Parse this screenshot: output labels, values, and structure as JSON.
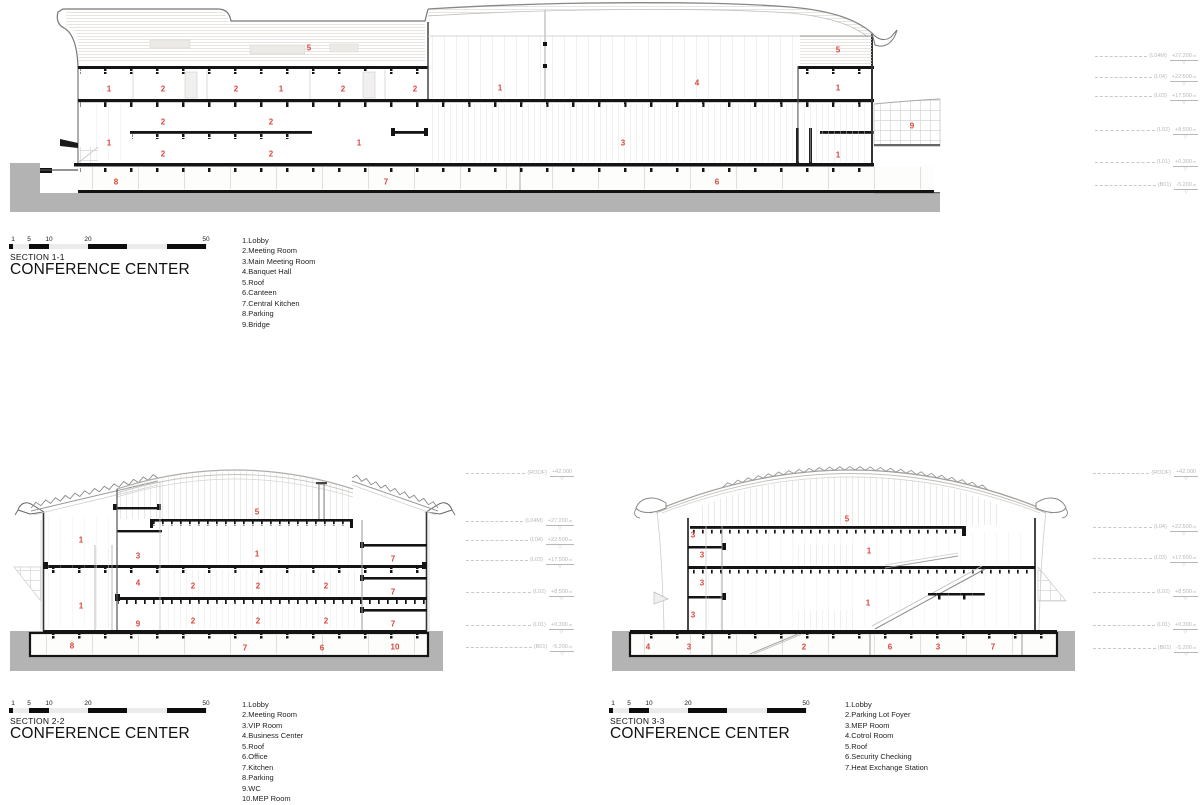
{
  "sheet": {
    "background": "#ffffff"
  },
  "colors": {
    "label_red": "#d8473c",
    "ground_gray": "#b3b3b3",
    "cut_black": "#141414",
    "marker_gray": "#b8b8b8"
  },
  "sections": [
    {
      "id": "section-1-1",
      "section_label": "SECTION 1-1",
      "title": "CONFERENCE CENTER",
      "scale_ticks": [
        "1",
        "5",
        "10",
        "20",
        "50"
      ],
      "legend_items": [
        "1.Lobby",
        "2.Meeting Room",
        "3.Main Meeting Room",
        "4.Banquet Hall",
        "5.Roof",
        "6.Canteen",
        "7.Central Kitchen",
        "8.Parking",
        "9.Bridge"
      ],
      "layout": {
        "scale_x": 9,
        "scale_y": 236,
        "label_x": 10,
        "label_y": 252,
        "title_x": 10,
        "title_y": 261,
        "legend_x": 242,
        "legend_y": 236
      },
      "labels": [
        {
          "t": "5",
          "x": 309,
          "y": 48
        },
        {
          "t": "1",
          "x": 109,
          "y": 89
        },
        {
          "t": "2",
          "x": 163,
          "y": 89
        },
        {
          "t": "2",
          "x": 236,
          "y": 89
        },
        {
          "t": "1",
          "x": 281,
          "y": 89
        },
        {
          "t": "2",
          "x": 343,
          "y": 89
        },
        {
          "t": "2",
          "x": 415,
          "y": 89
        },
        {
          "t": "1",
          "x": 500,
          "y": 88
        },
        {
          "t": "4",
          "x": 697,
          "y": 83
        },
        {
          "t": "5",
          "x": 838,
          "y": 50
        },
        {
          "t": "1",
          "x": 838,
          "y": 88
        },
        {
          "t": "2",
          "x": 163,
          "y": 122
        },
        {
          "t": "2",
          "x": 271,
          "y": 122
        },
        {
          "t": "9",
          "x": 912,
          "y": 126
        },
        {
          "t": "1",
          "x": 109,
          "y": 143
        },
        {
          "t": "1",
          "x": 359,
          "y": 143
        },
        {
          "t": "3",
          "x": 623,
          "y": 143
        },
        {
          "t": "2",
          "x": 163,
          "y": 154
        },
        {
          "t": "2",
          "x": 271,
          "y": 154
        },
        {
          "t": "1",
          "x": 838,
          "y": 155
        },
        {
          "t": "8",
          "x": 116,
          "y": 182
        },
        {
          "t": "7",
          "x": 386,
          "y": 182
        },
        {
          "t": "6",
          "x": 717,
          "y": 182
        }
      ],
      "levels": {
        "x": 1095,
        "w": 103,
        "rows": [
          {
            "n": "(L04M)",
            "v": "+27.200",
            "u": "m",
            "y": 56
          },
          {
            "n": "(L04)",
            "v": "+22.500",
            "u": "m",
            "y": 77
          },
          {
            "n": "(L03)",
            "v": "+17.500",
            "u": "m",
            "y": 96
          },
          {
            "n": "(L02)",
            "v": "+8.500",
            "u": "m",
            "y": 130
          },
          {
            "n": "(L01)",
            "v": "+0.300",
            "u": "m",
            "y": 162
          },
          {
            "n": "(B01)",
            "v": "-5.200",
            "u": "m",
            "y": 185
          }
        ]
      }
    },
    {
      "id": "section-2-2",
      "section_label": "SECTION 2-2",
      "title": "CONFERENCE CENTER",
      "scale_ticks": [
        "1",
        "5",
        "10",
        "20",
        "50"
      ],
      "legend_items": [
        "1.Lobby",
        "2.Meeting Room",
        "3.VIP Room",
        "4.Business Center",
        "5.Roof",
        "6.Office",
        "7.Kitchen",
        "8.Parking",
        "9.WC",
        "10.MEP Room"
      ],
      "layout": {
        "scale_x": 9,
        "scale_y": 700,
        "label_x": 10,
        "label_y": 716,
        "title_x": 10,
        "title_y": 725,
        "legend_x": 242,
        "legend_y": 700
      },
      "labels": [
        {
          "t": "5",
          "x": 257,
          "y": 512
        },
        {
          "t": "1",
          "x": 81,
          "y": 540
        },
        {
          "t": "3",
          "x": 138,
          "y": 556
        },
        {
          "t": "1",
          "x": 257,
          "y": 554
        },
        {
          "t": "7",
          "x": 393,
          "y": 559
        },
        {
          "t": "4",
          "x": 138,
          "y": 583
        },
        {
          "t": "2",
          "x": 193,
          "y": 586
        },
        {
          "t": "2",
          "x": 258,
          "y": 586
        },
        {
          "t": "2",
          "x": 326,
          "y": 586
        },
        {
          "t": "7",
          "x": 393,
          "y": 592
        },
        {
          "t": "1",
          "x": 81,
          "y": 606
        },
        {
          "t": "9",
          "x": 138,
          "y": 624
        },
        {
          "t": "2",
          "x": 193,
          "y": 621
        },
        {
          "t": "2",
          "x": 258,
          "y": 621
        },
        {
          "t": "2",
          "x": 326,
          "y": 621
        },
        {
          "t": "7",
          "x": 393,
          "y": 624
        },
        {
          "t": "8",
          "x": 72,
          "y": 646
        },
        {
          "t": "7",
          "x": 245,
          "y": 648
        },
        {
          "t": "6",
          "x": 322,
          "y": 648
        },
        {
          "t": "10",
          "x": 395,
          "y": 647
        }
      ],
      "levels": {
        "x": 466,
        "w": 108,
        "rows": [
          {
            "n": "(ROOF)",
            "v": "+42.000",
            "u": "",
            "y": 473
          },
          {
            "n": "(L04M)",
            "v": "+27.200",
            "u": "m",
            "y": 521
          },
          {
            "n": "(L04)",
            "v": "+22.500",
            "u": "m",
            "y": 540
          },
          {
            "n": "(L03)",
            "v": "+17.500",
            "u": "m",
            "y": 560
          },
          {
            "n": "(L02)",
            "v": "+8.500",
            "u": "m",
            "y": 592
          },
          {
            "n": "(L01)",
            "v": "+0.300",
            "u": "m",
            "y": 625
          },
          {
            "n": "(B01)",
            "v": "-5.200",
            "u": "m",
            "y": 647
          }
        ]
      }
    },
    {
      "id": "section-3-3",
      "section_label": "SECTION 3-3",
      "title": "CONFERENCE CENTER",
      "scale_ticks": [
        "1",
        "5",
        "10",
        "20",
        "50"
      ],
      "legend_items": [
        "1.Lobby",
        "2.Parking Lot Foyer",
        "3.MEP Room",
        "4.Cotrol Room",
        "5.Roof",
        "6.Security Checking",
        "7.Heat Exchange Station"
      ],
      "layout": {
        "scale_x": 609,
        "scale_y": 700,
        "label_x": 610,
        "label_y": 716,
        "title_x": 610,
        "title_y": 725,
        "legend_x": 845,
        "legend_y": 700
      },
      "labels": [
        {
          "t": "5",
          "x": 847,
          "y": 519
        },
        {
          "t": "3",
          "x": 693,
          "y": 535
        },
        {
          "t": "3",
          "x": 702,
          "y": 555
        },
        {
          "t": "1",
          "x": 869,
          "y": 551
        },
        {
          "t": "3",
          "x": 702,
          "y": 583
        },
        {
          "t": "3",
          "x": 693,
          "y": 615
        },
        {
          "t": "1",
          "x": 868,
          "y": 603
        },
        {
          "t": "4",
          "x": 648,
          "y": 647
        },
        {
          "t": "3",
          "x": 689,
          "y": 647
        },
        {
          "t": "2",
          "x": 804,
          "y": 647
        },
        {
          "t": "6",
          "x": 890,
          "y": 647
        },
        {
          "t": "3",
          "x": 938,
          "y": 647
        },
        {
          "t": "7",
          "x": 993,
          "y": 647
        }
      ],
      "levels": {
        "x": 1093,
        "w": 105,
        "rows": [
          {
            "n": "(ROOF)",
            "v": "+42.000",
            "u": "",
            "y": 473
          },
          {
            "n": "(L04)",
            "v": "+22.500",
            "u": "m",
            "y": 527
          },
          {
            "n": "(L03)",
            "v": "+17.500",
            "u": "m",
            "y": 558
          },
          {
            "n": "(L02)",
            "v": "+8.500",
            "u": "m",
            "y": 592
          },
          {
            "n": "(L01)",
            "v": "+0.300",
            "u": "m",
            "y": 625
          },
          {
            "n": "(B01)",
            "v": "-5.200",
            "u": "m",
            "y": 648
          }
        ]
      }
    }
  ]
}
